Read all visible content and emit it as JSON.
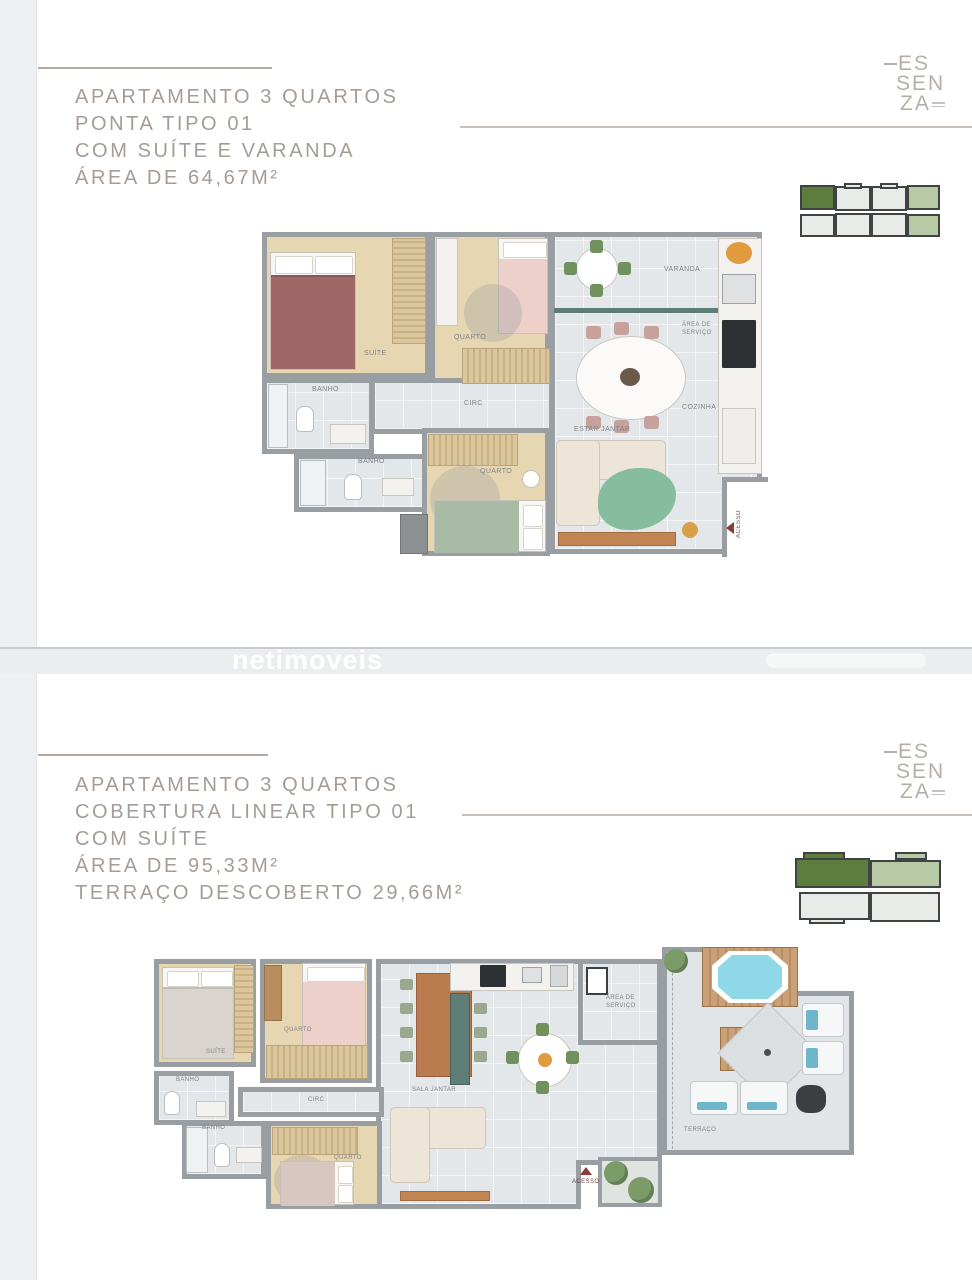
{
  "brand": {
    "line1": "ES",
    "line2": "SEN",
    "line3": "ZA"
  },
  "watermark": "netimoveis",
  "section1": {
    "title_lines": [
      "APARTAMENTO 3 QUARTOS",
      "PONTA TIPO 01",
      "COM SUÍTE E VARANDA",
      "ÁREA DE 64,67M²"
    ],
    "plan_labels": {
      "suite": "SUÍTE",
      "quarto_top": "QUARTO",
      "quarto_bottom": "QUARTO",
      "banho_top": "BANHO",
      "banho_bottom": "BANHO",
      "circ": "CIRC",
      "estar_jantar": "ESTAR JANTAR",
      "cozinha": "COZINHA",
      "servico_l1": "ÁREA DE",
      "servico_l2": "SERVIÇO",
      "varanda": "VARANDA",
      "acesso": "ACESSO"
    }
  },
  "section2": {
    "title_lines": [
      "APARTAMENTO 3 QUARTOS",
      "COBERTURA LINEAR TIPO 01",
      "COM SUÍTE",
      "ÁREA DE 95,33M²",
      "TERRAÇO DESCOBERTO 29,66M²"
    ],
    "plan_labels": {
      "suite": "SUÍTE",
      "quarto_top": "QUARTO",
      "quarto_bottom": "QUARTO",
      "banho_top": "BANHO",
      "banho_bottom": "BANHO",
      "circ": "CIRC",
      "sala_jantar": "SALA JANTAR",
      "servico_l1": "ÁREA DE",
      "servico_l2": "SERVIÇO",
      "terraco": "TERRAÇO",
      "acesso": "ACESSO"
    }
  },
  "colors": {
    "highlight_dark_green": "#5d7d3f",
    "highlight_sage": "#b8c9a5",
    "title_taupe": "#a59c96",
    "accent_red": "#8e3b3b",
    "jacuzzi_blue": "#8fd8e8",
    "page_gutter": "#eef0f2"
  }
}
